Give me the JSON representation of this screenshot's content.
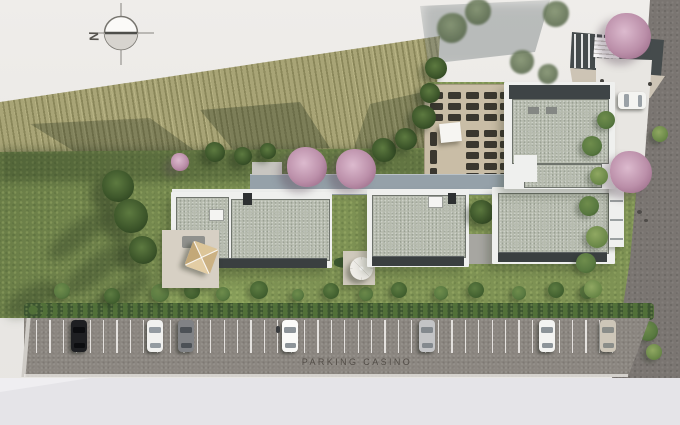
{
  "compass": {
    "label": "N"
  },
  "parking_lot": {
    "label": "PARKING CASINO",
    "asphalt_color": "#8c8781",
    "line_color": "#f0eeea",
    "stall_lines": {
      "start": 36,
      "step": 13.4,
      "count": 44,
      "y": 320,
      "h": 33
    },
    "car_y": 320,
    "car_w": 16,
    "car_h": 32,
    "cars": [
      {
        "x": 71,
        "color": "#1e1f22",
        "glass": "#0c0d10",
        "name": "black-car"
      },
      {
        "x": 147,
        "color": "#f1f1ef",
        "glass": "#949ba1",
        "name": "white-car"
      },
      {
        "x": 178,
        "color": "#808285",
        "glass": "#4c5156",
        "name": "gray-car"
      },
      {
        "x": 282,
        "color": "#fafaf8",
        "glass": "#8d9499",
        "name": "white-van"
      },
      {
        "x": 419,
        "color": "#c3c4c6",
        "glass": "#83898e",
        "name": "silver-car"
      },
      {
        "x": 539,
        "color": "#f3f3f1",
        "glass": "#8d9499",
        "name": "white-car"
      },
      {
        "x": 600,
        "color": "#cdc6b8",
        "glass": "#8a8d89",
        "name": "beige-car"
      }
    ]
  },
  "scene": {
    "driveway_car": {
      "x": 618,
      "y": 92,
      "w": 28,
      "h": 17,
      "color": "#f4f4f1",
      "glass": "#9aa1a6"
    },
    "lawn_trees": [
      {
        "x": 118,
        "y": 186,
        "r": 16
      },
      {
        "x": 131,
        "y": 216,
        "r": 17
      },
      {
        "x": 143,
        "y": 250,
        "r": 14
      }
    ],
    "field_trees": [
      {
        "x": 215,
        "y": 152,
        "r": 10
      },
      {
        "x": 243,
        "y": 156,
        "r": 9
      },
      {
        "x": 268,
        "y": 151,
        "r": 8
      },
      {
        "x": 384,
        "y": 150,
        "r": 12
      },
      {
        "x": 406,
        "y": 139,
        "r": 11
      },
      {
        "x": 424,
        "y": 117,
        "r": 12
      },
      {
        "x": 430,
        "y": 93,
        "r": 10
      },
      {
        "x": 436,
        "y": 68,
        "r": 11
      }
    ],
    "gray_trees": [
      {
        "x": 452,
        "y": 28,
        "r": 15
      },
      {
        "x": 478,
        "y": 12,
        "r": 13
      },
      {
        "x": 522,
        "y": 62,
        "r": 12
      },
      {
        "x": 548,
        "y": 74,
        "r": 10
      },
      {
        "x": 556,
        "y": 14,
        "r": 13
      }
    ],
    "pink_trees": [
      {
        "x": 180,
        "y": 162,
        "r": 9
      },
      {
        "x": 307,
        "y": 167,
        "r": 20
      },
      {
        "x": 356,
        "y": 169,
        "r": 20
      },
      {
        "x": 628,
        "y": 36,
        "r": 23
      },
      {
        "x": 631,
        "y": 172,
        "r": 21
      }
    ],
    "garden_bushes": [
      {
        "x": 62,
        "y": 291,
        "r": 8
      },
      {
        "x": 112,
        "y": 296,
        "r": 8
      },
      {
        "x": 160,
        "y": 293,
        "r": 9
      },
      {
        "x": 192,
        "y": 291,
        "r": 8
      },
      {
        "x": 223,
        "y": 294,
        "r": 7
      },
      {
        "x": 259,
        "y": 290,
        "r": 9
      },
      {
        "x": 298,
        "y": 295,
        "r": 6
      },
      {
        "x": 331,
        "y": 291,
        "r": 8
      },
      {
        "x": 366,
        "y": 294,
        "r": 7
      },
      {
        "x": 399,
        "y": 290,
        "r": 8
      },
      {
        "x": 441,
        "y": 293,
        "r": 7
      },
      {
        "x": 476,
        "y": 290,
        "r": 8
      },
      {
        "x": 519,
        "y": 293,
        "r": 7
      },
      {
        "x": 556,
        "y": 290,
        "r": 8
      },
      {
        "x": 587,
        "y": 292,
        "r": 7
      }
    ],
    "road_bushes": [
      {
        "x": 606,
        "y": 120,
        "r": 9
      },
      {
        "x": 660,
        "y": 134,
        "r": 8
      },
      {
        "x": 592,
        "y": 146,
        "r": 10
      },
      {
        "x": 599,
        "y": 176,
        "r": 9
      },
      {
        "x": 589,
        "y": 206,
        "r": 10
      },
      {
        "x": 597,
        "y": 237,
        "r": 11
      },
      {
        "x": 586,
        "y": 263,
        "r": 10
      },
      {
        "x": 593,
        "y": 289,
        "r": 9
      },
      {
        "x": 648,
        "y": 331,
        "r": 10
      },
      {
        "x": 654,
        "y": 352,
        "r": 8
      }
    ],
    "amenity": {
      "stall_color": "#3a372f",
      "block1": {
        "cols": [
          430,
          448,
          466,
          484,
          500
        ],
        "rows": [
          92,
          103,
          114
        ],
        "w": 13,
        "h": 7
      },
      "block2": {
        "cols": [
          466,
          484,
          500
        ],
        "rows": [
          130,
          141,
          152,
          163,
          173
        ],
        "w": 13,
        "h": 7
      },
      "block3": {
        "cols": [
          430
        ],
        "rows": [
          132,
          150,
          168
        ],
        "w": 7,
        "h": 14
      }
    }
  }
}
